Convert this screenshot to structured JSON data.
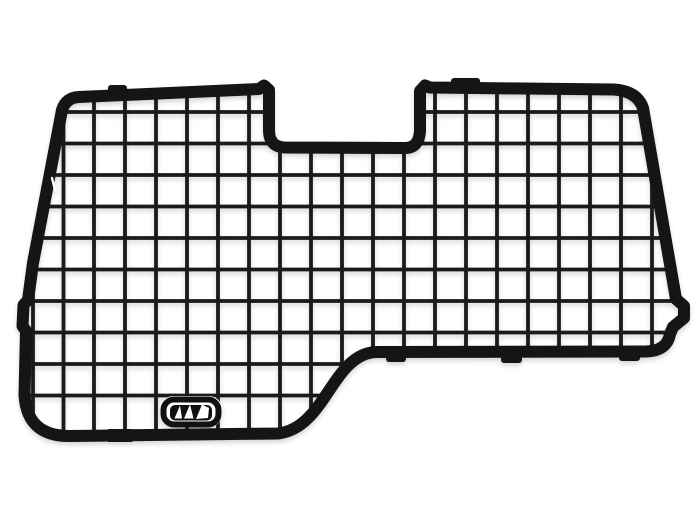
{
  "page": {
    "background_color": "#ffffff"
  },
  "product_photo": {
    "subject": "van-rear-window-wire-mesh-grille",
    "frame_color": "#151515",
    "wire_color": "#1a1a1a",
    "seam_color": "#ffffff",
    "mesh": {
      "visible_columns": 20,
      "visible_rows": 10
    },
    "badge": {
      "name": "three-sails-brand-badge",
      "outline_color": "#111111",
      "field_color": "#111111",
      "sail_color": "#ffffff",
      "sail_count": 3
    }
  }
}
